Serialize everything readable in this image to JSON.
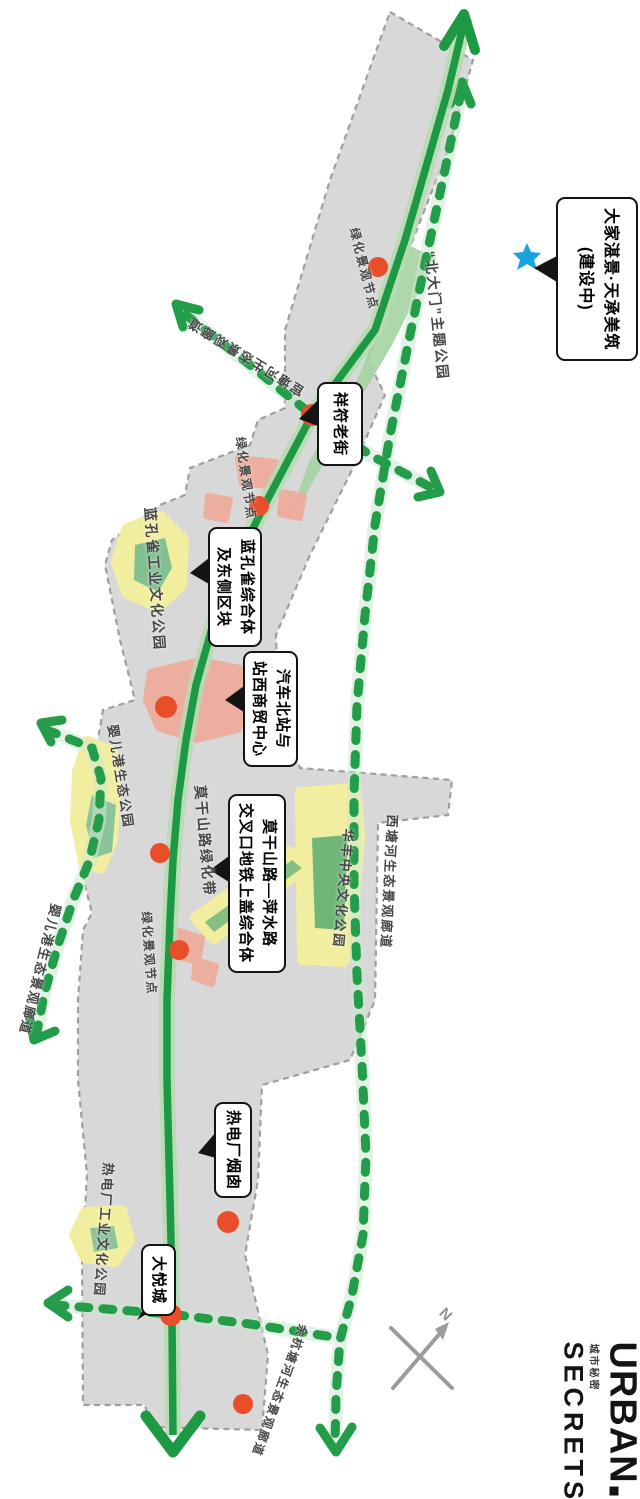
{
  "map": {
    "callouts": [
      {
        "id": "dajia-project",
        "lines": [
          "大家湛景·天承美筑",
          "(建设中)"
        ]
      },
      {
        "id": "xiangfu-old-street",
        "lines": [
          "祥符老街"
        ]
      },
      {
        "id": "blue-peacock-complex",
        "lines": [
          "蓝孔雀综合体",
          "及东侧区块"
        ]
      },
      {
        "id": "north-bus-station",
        "lines": [
          "汽车北站与",
          "站西商贸中心"
        ]
      },
      {
        "id": "metro-tod-complex",
        "lines": [
          "莫干山路—萍水路",
          "交叉口地铁上盖综合体"
        ]
      },
      {
        "id": "power-plant-chimney",
        "lines": [
          "热电厂烟囱"
        ]
      },
      {
        "id": "joy-city",
        "lines": [
          "大悦城"
        ]
      }
    ],
    "labels": [
      {
        "id": "green-node-1",
        "text": "绿化景观节点"
      },
      {
        "id": "north-gate-park",
        "text": "“北大门”主题公园"
      },
      {
        "id": "huantang-corridor",
        "text": "宦塘河生态景观廊道"
      },
      {
        "id": "green-node-2",
        "text": "绿化景观节点"
      },
      {
        "id": "blue-peacock-park",
        "text": "蓝孔雀工业文化公园"
      },
      {
        "id": "yingergang-park",
        "text": "婴儿港生态公园"
      },
      {
        "id": "moganshan-green-belt",
        "text": "莫干山路绿化带"
      },
      {
        "id": "xitang-corridor",
        "text": "西塘河生态景观廊道"
      },
      {
        "id": "huafeng-park",
        "text": "华丰中央文化公园"
      },
      {
        "id": "yingergang-corridor",
        "text": "婴儿港生态景观廊道"
      },
      {
        "id": "green-node-3",
        "text": "绿化景观节点"
      },
      {
        "id": "power-plant-park",
        "text": "热电厂工业文化公园"
      },
      {
        "id": "yuhangtang-corridor",
        "text": "余杭塘河生态景观廊道"
      }
    ],
    "compass_label": "N",
    "logo": {
      "urban": "URBAN",
      "secrets": "SECRETS",
      "cn": "城市秘密"
    },
    "colors": {
      "planning_area": "#d8d8d8",
      "area_border": "#9f9f9f",
      "greenway": "#1d9943",
      "greenway_halo": "#b6dcb2",
      "eco_corridor": "#239d49",
      "node_dot": "#e84e2a",
      "built_pink": "#eeab9a",
      "park_yellow": "#f2eea0",
      "park_green": "#82c092",
      "star_blue": "#18a3dd"
    }
  }
}
